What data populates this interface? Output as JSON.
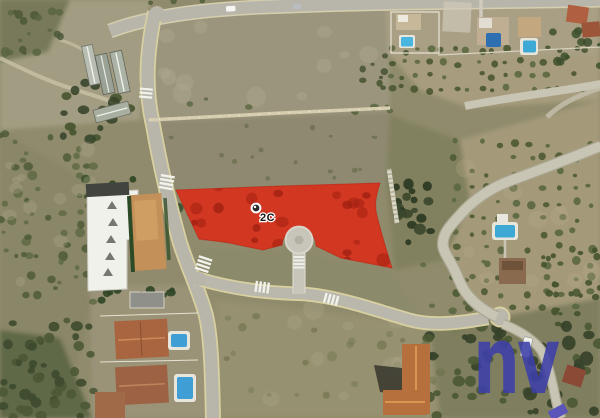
{
  "map": {
    "type": "aerial-satellite-view",
    "parcel": {
      "label": "2C",
      "highlight_color": "#DC2A16",
      "marker_icon": "circle-marker"
    },
    "watermark": {
      "text": "nv",
      "color": "#3C3FA8"
    },
    "colors": {
      "pool_blue": "#3FA9D6",
      "road_gray": "#B8B5AB",
      "terrain_olive": "#8F8B6C",
      "roof_terracotta": "#A8653F"
    }
  }
}
